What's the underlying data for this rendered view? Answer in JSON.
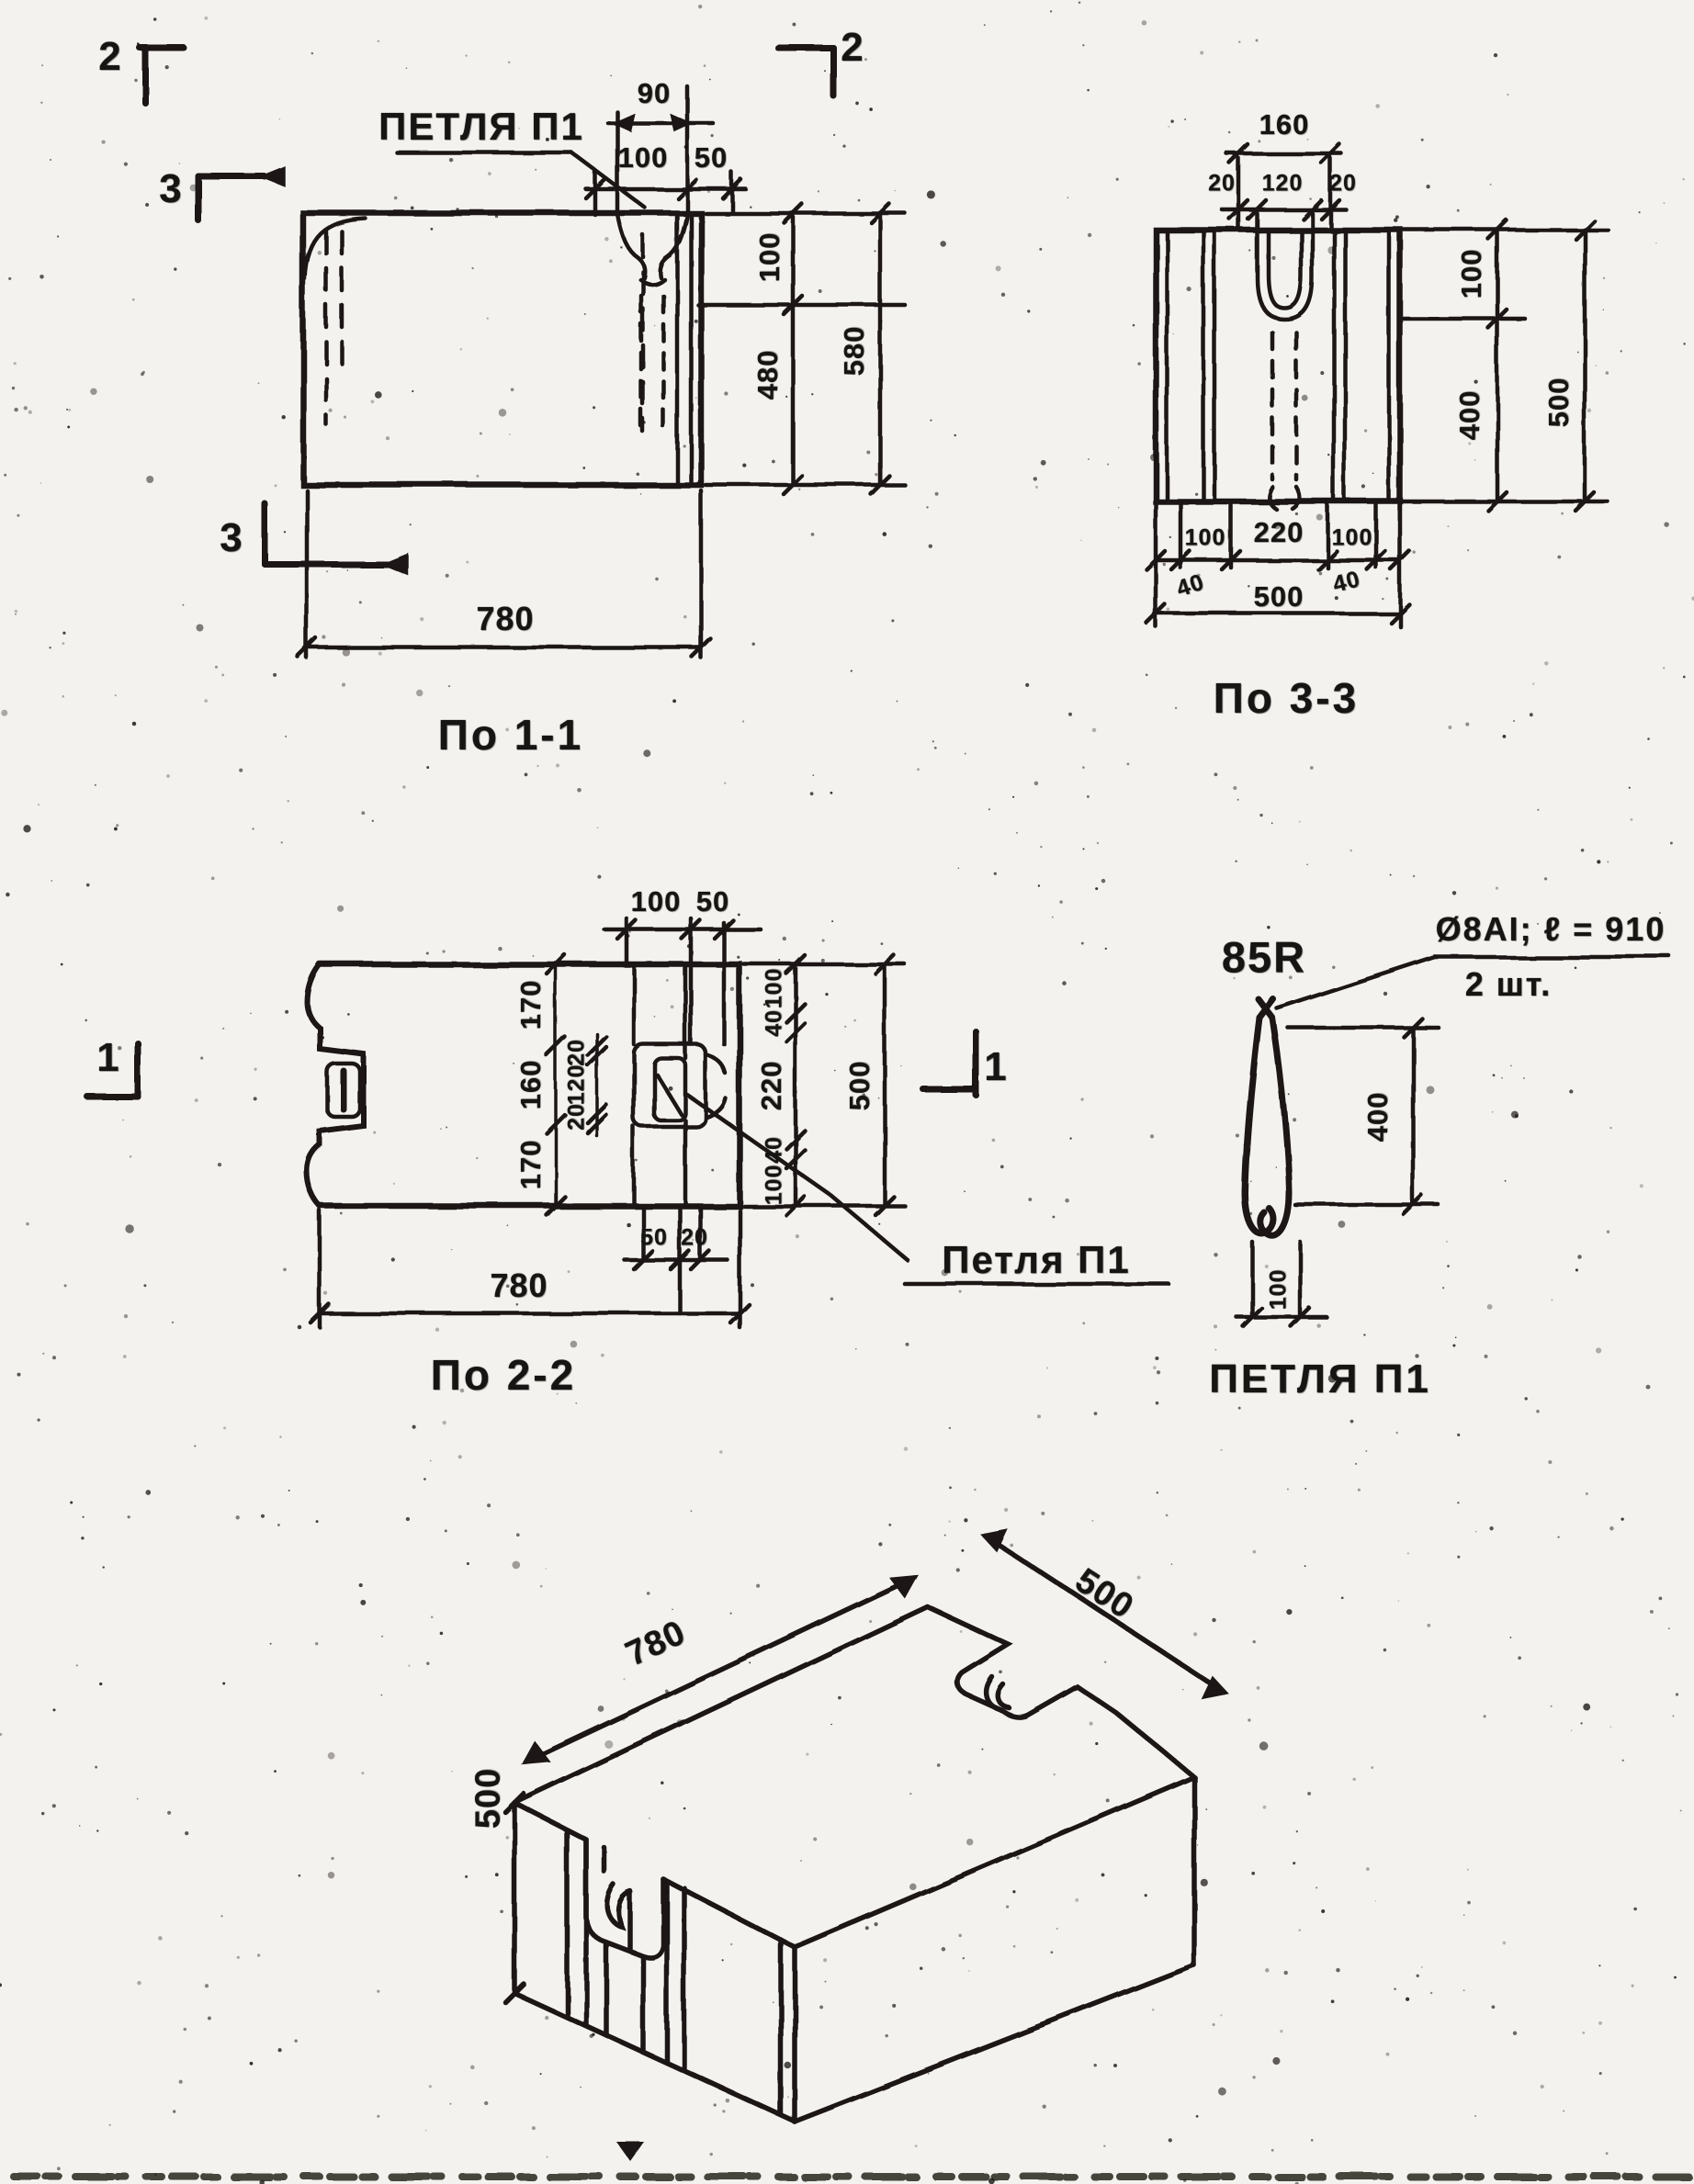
{
  "view1": {
    "title": "По 1-1",
    "loop_label": "ПЕТЛЯ П1",
    "marker_2_left": "2",
    "marker_2_right": "2",
    "marker_3_top": "3",
    "marker_3_bottom": "3",
    "dim_top_90": "90",
    "dim_top_100": "100",
    "dim_top_50": "50",
    "dim_right_100": "100",
    "dim_right_480": "480",
    "dim_right_580": "580",
    "dim_bottom_780": "780"
  },
  "view33": {
    "title": "По 3-3",
    "dim_160": "160",
    "dim_20_left": "20",
    "dim_120": "120",
    "dim_20_right": "20",
    "dim_100_top": "100",
    "dim_400": "400",
    "dim_500_right": "500",
    "dim_100_bl": "100",
    "dim_220": "220",
    "dim_100_br": "100",
    "dim_40_left": "40",
    "dim_500_bottom": "500",
    "dim_40_right": "40"
  },
  "view22": {
    "title": "По 2-2",
    "marker_1_left": "1",
    "marker_1_right": "1",
    "dim_top_100": "100",
    "dim_top_50": "50",
    "chain_outer": [
      "170",
      "160",
      "170"
    ],
    "chain_inner": [
      "20",
      "120",
      "20"
    ],
    "chain_right": [
      "100",
      "40",
      "220",
      "40",
      "100"
    ],
    "dim_right_500": "500",
    "dim_bot_50": "50",
    "dim_bot_20": "20",
    "dim_bottom_780": "780",
    "loop_label": "Петля П1"
  },
  "loop_detail": {
    "title": "ПЕТЛЯ П1",
    "bend_label": "85R",
    "spec_line1": "Ø8АI; ℓ = 910",
    "spec_line2": "2 шт.",
    "dim_400": "400",
    "dim_100": "100"
  },
  "iso": {
    "dim_780": "780",
    "dim_500_top": "500",
    "dim_500_left": "500"
  }
}
